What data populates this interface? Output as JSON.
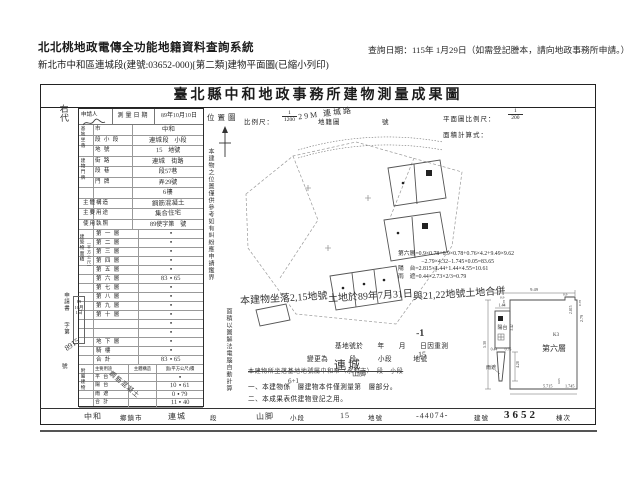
{
  "header": {
    "system_name": "北北桃地政電傳全功能地籍資料查詢系統",
    "subtitle": "新北市中和區連城段(建號:03652-000)[第二類]建物平面圖(已縮小列印)",
    "query_note": "查詢日期：115年 1月29日（如需登記謄本，請向地政事務所申請。）"
  },
  "doc": {
    "title": "臺北縣中和地政事務所建物測量成果圖",
    "margin_note": "右代"
  },
  "applicant": {
    "label": "申請人"
  },
  "survey": {
    "label": "測量日期",
    "parts": [
      {
        "t": "89",
        "h": 1
      },
      {
        "t": "年",
        "h": 0
      },
      {
        "t": "10",
        "h": 1
      },
      {
        "t": "月",
        "h": 0
      },
      {
        "t": "10",
        "h": 1
      },
      {
        "t": "日",
        "h": 0
      }
    ]
  },
  "site": {
    "group1": "基地坐落",
    "group2": "建物門牌"
  },
  "form_rows": [
    {
      "label": "市",
      "parts": [
        {
          "t": "中和",
          "h": 1
        }
      ]
    },
    {
      "label": "段 小 段",
      "parts": [
        {
          "t": "連城",
          "h": 1
        },
        {
          "t": "段　小段",
          "h": 0
        }
      ]
    },
    {
      "label": "地 號",
      "parts": [
        {
          "t": "15",
          "h": 1
        },
        {
          "t": "　地號",
          "h": 0
        }
      ]
    },
    {
      "label": "街 路",
      "parts": [
        {
          "t": "連城",
          "h": 1
        },
        {
          "t": "　街路",
          "h": 0
        }
      ]
    },
    {
      "label": "段 巷",
      "parts": [
        {
          "t": "段",
          "h": 0
        },
        {
          "t": "57",
          "h": 1
        },
        {
          "t": "巷",
          "h": 0
        }
      ]
    },
    {
      "label": "門 牌",
      "parts": [
        {
          "t": "弄",
          "h": 0
        },
        {
          "t": "29",
          "h": 1
        },
        {
          "t": "號",
          "h": 0
        }
      ]
    },
    {
      "label": "",
      "parts": [
        {
          "t": "6",
          "h": 1
        },
        {
          "t": "樓",
          "h": 0
        }
      ]
    },
    {
      "label": "主體構造",
      "wide": 1,
      "parts": [
        {
          "t": "鋼筋混凝土",
          "h": 1
        }
      ]
    },
    {
      "label": "主要用途",
      "wide": 1,
      "parts": [
        {
          "t": "集合住宅",
          "h": 1
        }
      ]
    },
    {
      "label": "使用執照",
      "wide": 1,
      "parts": [
        {
          "t": "89",
          "h": 1
        },
        {
          "t": "使字第",
          "h": 0
        },
        {
          "t": "　號",
          "h": 0
        }
      ]
    }
  ],
  "floors": {
    "side_label1": "建築物面積",
    "side_label2": "（平方公尺）",
    "rows": [
      {
        "label": "第 一 層",
        "l": "",
        "r": ""
      },
      {
        "label": "第 二 層",
        "l": "",
        "r": ""
      },
      {
        "label": "第 三 層",
        "l": "",
        "r": ""
      },
      {
        "label": "第 四 層",
        "l": "",
        "r": ""
      },
      {
        "label": "第 五 層",
        "l": "",
        "r": ""
      },
      {
        "label": "第 六 層",
        "l": "83",
        "r": "65"
      },
      {
        "label": "第 七 層",
        "l": "",
        "r": ""
      },
      {
        "label": "第 八 層",
        "l": "",
        "r": ""
      },
      {
        "label": "第 九 層",
        "l": "",
        "r": ""
      },
      {
        "label": "第 十 層",
        "l": "",
        "r": ""
      },
      {
        "label": "",
        "l": "",
        "r": ""
      },
      {
        "label": "",
        "l": "",
        "r": ""
      },
      {
        "label": "地 下 層",
        "l": "",
        "r": ""
      },
      {
        "label": "騎 樓",
        "l": "",
        "r": ""
      },
      {
        "label": "合 計",
        "l": "83",
        "r": "65"
      }
    ]
  },
  "application": {
    "label": "申請書",
    "zi": "字第",
    "number": "8915",
    "hao": "號",
    "stamp": [
      "89",
      "10月",
      "1日"
    ]
  },
  "annex": {
    "side_label": "附屬建物",
    "headers": [
      "主要用途",
      "主體構造",
      "面(平方公尺)積"
    ],
    "diagonal": "鋼筋混凝土",
    "rows": [
      {
        "use": "平 台",
        "l": "",
        "r": ""
      },
      {
        "use": "陽 台",
        "l": "10",
        "r": "61"
      },
      {
        "use": "雨 遮",
        "l": "0",
        "r": "79"
      },
      {
        "use": "合 計",
        "l": "11",
        "r": "40"
      }
    ]
  },
  "location": {
    "label": "位置圖",
    "scale_label": "比例尺：",
    "scale_num": "1",
    "scale_den": "1200",
    "cadastre": "地籍圖",
    "no": "號",
    "road_label": "29M 連城路"
  },
  "plan": {
    "scale_label": "平面圖比例尺：",
    "num": "1",
    "den": "200",
    "calc_label": "面積計算式：",
    "floor_label": "第六層",
    "k3": "K3",
    "balcony": "陽台",
    "eave": "雨遮",
    "dims": {
      "w": "9.49",
      "n1": "0.9",
      "n2": "0.78",
      "tr": "2.815",
      "n3": "0.9",
      "n4": "0.78",
      "bw": "1.44",
      "bh": "3.42",
      "lh": "5.30",
      "rt": "2.79",
      "e1": "0.44",
      "e2": "0.76",
      "eh": "4.28",
      "b1": "5.715",
      "b2": "1.745",
      "b3": "0.05"
    }
  },
  "calc": {
    "lines": [
      "第六層=0.9×0.78+0.9×0.78+0.76×4.2+9.49×9.62",
      "　　　　−2.79×4.32−1.745×0.05=83.65",
      "陽　台=2.815×1.44+1.44×4.55=10.61",
      "雨　遮=0.44×2.73×2/3=0.79"
    ]
  },
  "handnote": {
    "lines": [
      "本建物坐落2,15地號",
      "土地於89年7月31日",
      "與21,22地號土地合併"
    ]
  },
  "notes": {
    "mark": "-1",
    "line1": "基地號於　　年　　月　　日因重測",
    "line2": "變更為　　　段　　　小段　　　地號",
    "line2_hand": "15",
    "big_hand": "連城",
    "small_hand": "山脚",
    "line3": "本建物所坐落基地地號屬中和市（永和市）　段　小段",
    "line4": "一、本建物係　層建物本件僅測量第　層部分。",
    "line4_hand": "6+1",
    "line5": "二、本成果表供建物登記之用。"
  },
  "side_notes": {
    "a": "本建物之位置僅供參考如有糾紛應申請鑑界",
    "b": "面積以圖解法電腦自動計算"
  },
  "footer": {
    "cells": [
      {
        "t": "中和",
        "h": 1
      },
      {
        "t": "鄉鎮市",
        "h": 0
      },
      {
        "t": "連城",
        "h": 1
      },
      {
        "t": "段",
        "h": 0
      },
      {
        "t": "山脚",
        "h": 1
      },
      {
        "t": "小段",
        "h": 0
      },
      {
        "t": "15",
        "h": 1
      },
      {
        "t": "地號",
        "h": 0
      },
      {
        "t": "-44074-",
        "h": 1
      },
      {
        "t": "建號",
        "h": 0
      },
      {
        "t": "3652",
        "h": 0,
        "big": 1
      },
      {
        "t": "棟次",
        "h": 0
      }
    ]
  }
}
